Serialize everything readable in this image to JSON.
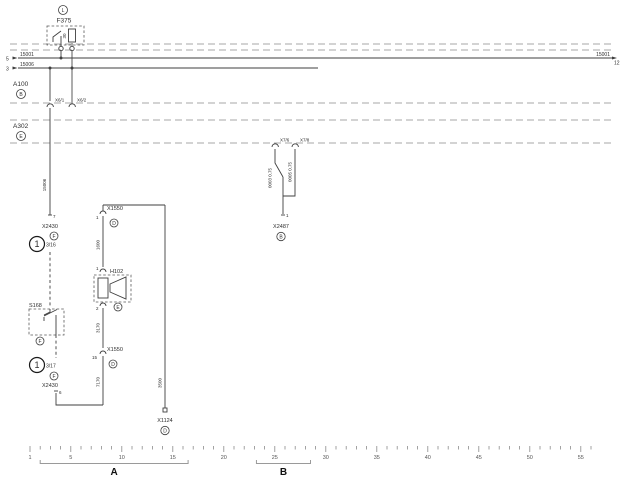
{
  "diagram": {
    "fuse": {
      "location": "L",
      "name": "F375",
      "rating": "30"
    },
    "bus1": {
      "left_pin": "5",
      "left_label": "15001",
      "right_label": "15001",
      "right_pin": "12"
    },
    "bus2": {
      "left_pin": "3",
      "left_label": "15006"
    },
    "a100": {
      "name": "A100",
      "location": "B",
      "pin1": "X6/1",
      "pin2": "X6/2"
    },
    "a302": {
      "name": "A302",
      "location": "E",
      "pin1": "X7/6",
      "pin2": "X7/8"
    },
    "left": {
      "wire": "15006",
      "top_pin": "7",
      "x2430_top": "X2430",
      "x2430_top_loc": "F",
      "note_top": "1",
      "ref_top": "3/16",
      "s168": "S168",
      "s168_loc": "F",
      "note_bottom": "1",
      "ref_bottom": "3/17",
      "x2430_bottom_loc": "F",
      "x2430_bottom": "X2430",
      "bottom_pin": "6"
    },
    "mid": {
      "x1550_top": "X1550",
      "x1550_top_pin": "1",
      "x1550_top_loc": "D",
      "wire_top": "1600",
      "h102": "H102",
      "h102_pin_top": "1",
      "h102_pin_bottom": "2",
      "h102_loc": "E",
      "wire_mid": "3170",
      "x1550_bottom": "X1550",
      "x1550_bottom_pin": "15",
      "x1550_bottom_loc": "D",
      "wire_bottom": "7170"
    },
    "right_vertical": {
      "wire": "3500",
      "x1124": "X1124",
      "x1124_loc": "D"
    },
    "a302_branch": {
      "wire_left": "0003 0.75",
      "wire_right": "0005 0.75",
      "pin": "1",
      "x2487": "X2487",
      "x2487_loc": "B"
    }
  },
  "ruler": {
    "first_track": 1,
    "last_track": 56,
    "numbers": [
      1,
      5,
      10,
      15,
      20,
      25,
      30,
      35,
      40,
      45,
      50,
      55
    ],
    "section_a": {
      "label": "A",
      "from_track": 2,
      "to_track": 16.5
    },
    "section_b": {
      "label": "B",
      "from_track": 23.2,
      "to_track": 28.5
    }
  },
  "colors": {
    "wire": "#3f3f3f",
    "thick_wire": "#a9a9a9",
    "boundary": "#8a8a8a",
    "background": "#ffffff"
  }
}
